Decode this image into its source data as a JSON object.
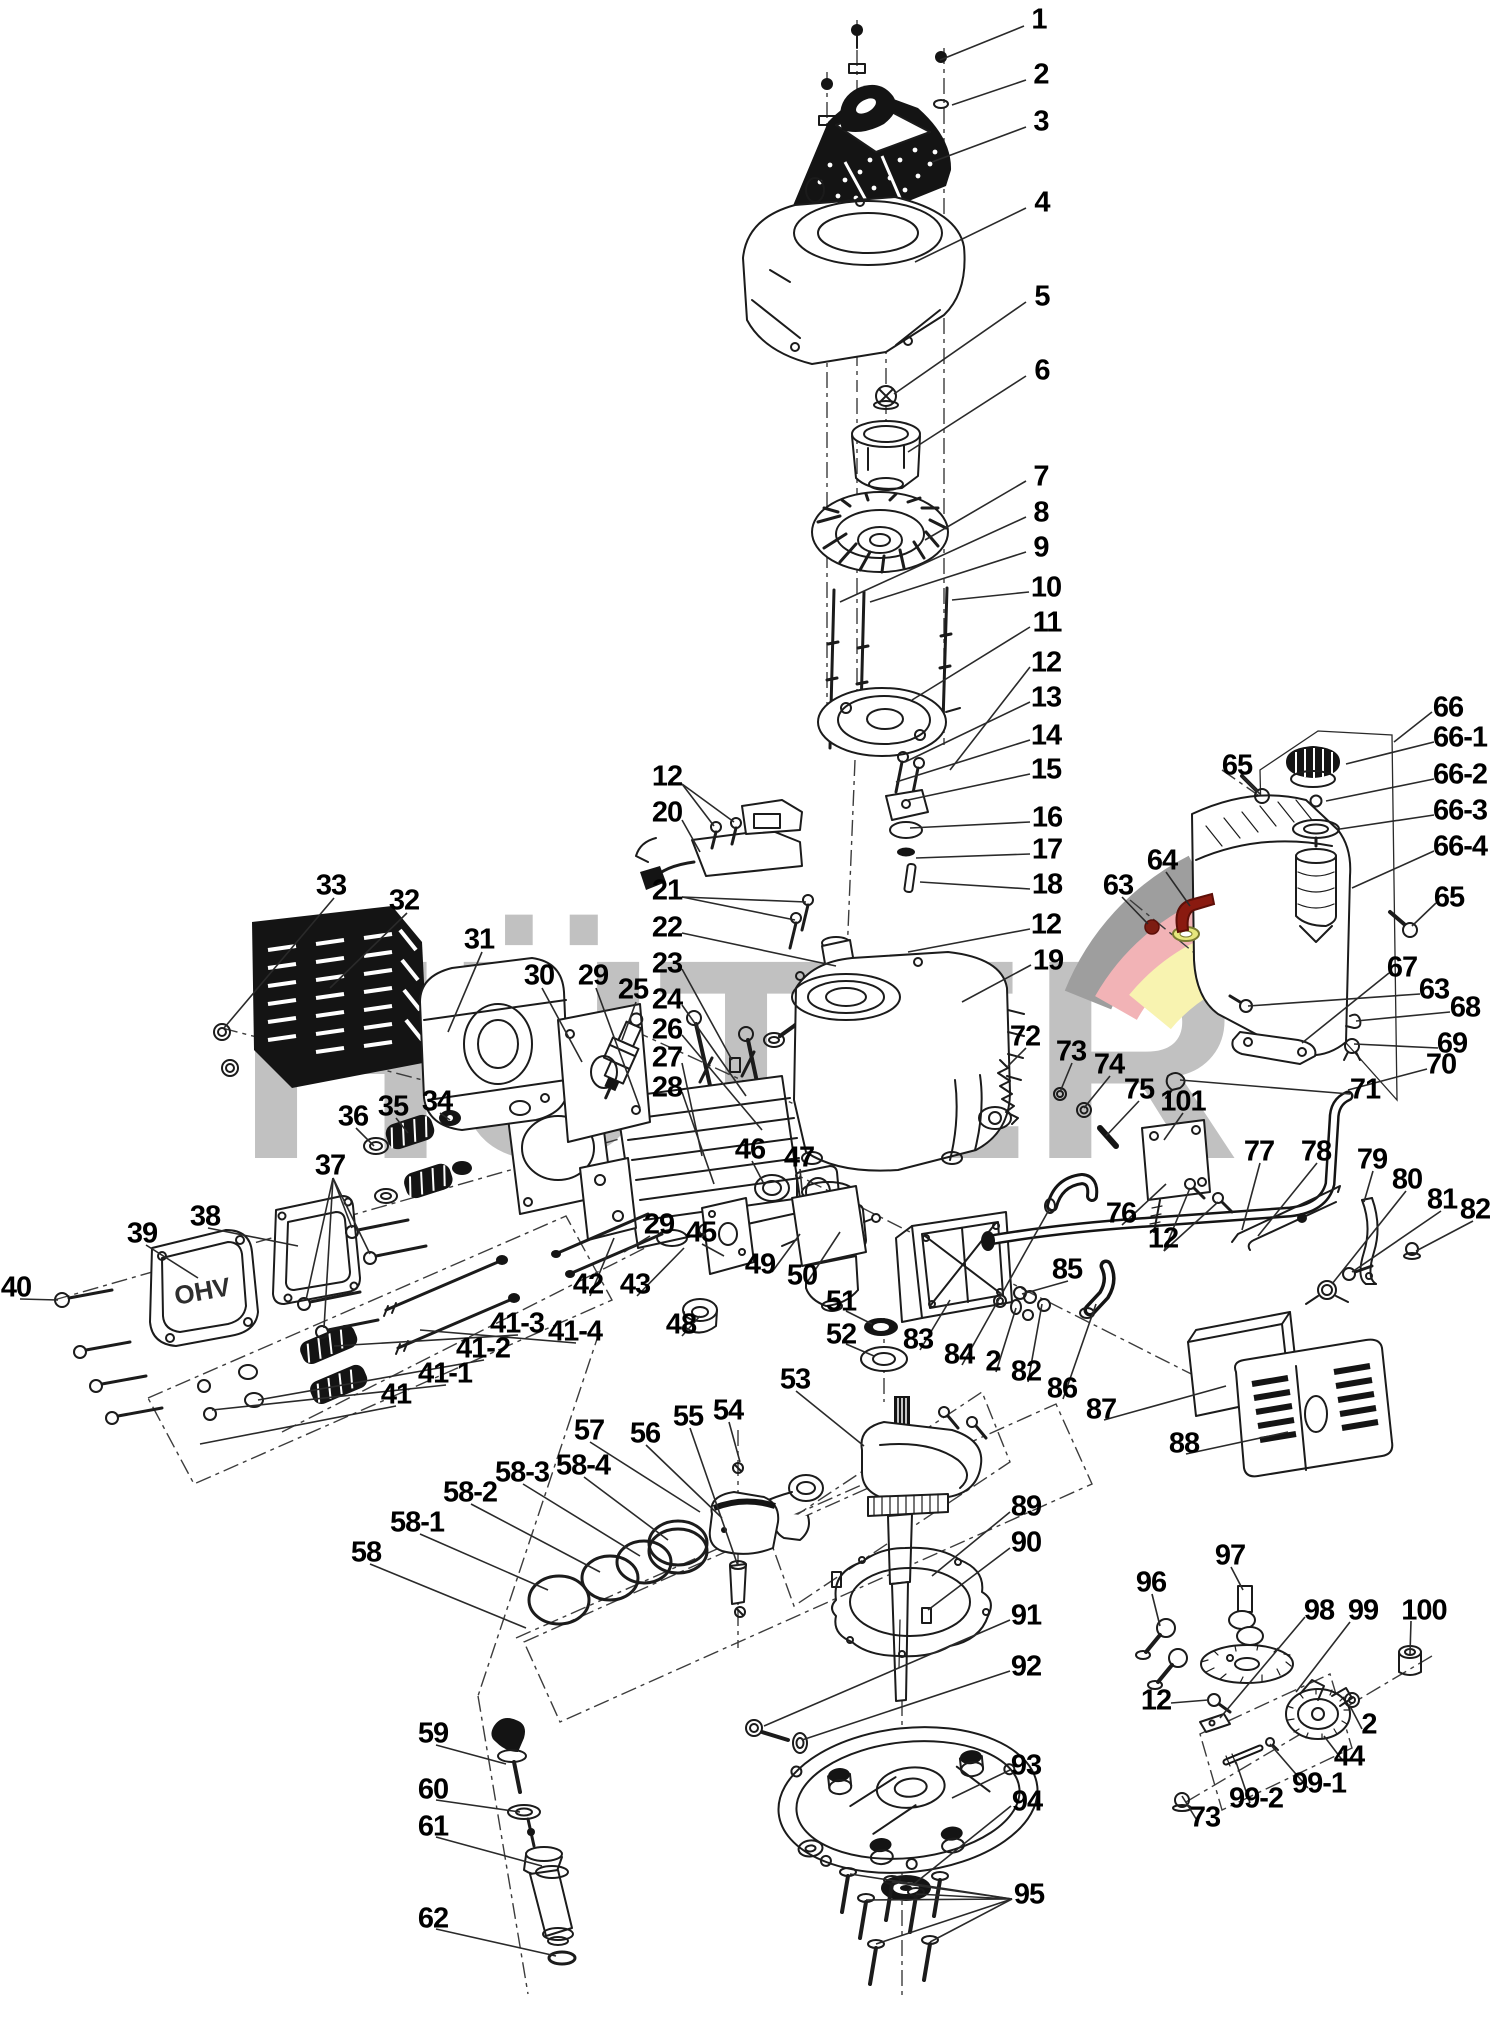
{
  "watermark": {
    "text": "HÜTER",
    "color": "#c1c1c1"
  },
  "logo": {
    "arc_gray": "#9e9e9e",
    "arc_red": "#f2b3b6",
    "arc_yellow": "#f8f3b0"
  },
  "highlighted_parts": {
    "bracket_color": "#8a1a10",
    "nut_color": "#7d1d12",
    "washer_color": "#e7e77d"
  },
  "parts_text": {
    "valve_cover": "OHV"
  },
  "labels": [
    {
      "id": "1",
      "text": "1",
      "x": 1039,
      "y": 20
    },
    {
      "id": "2",
      "text": "2",
      "x": 1041,
      "y": 75
    },
    {
      "id": "3",
      "text": "3",
      "x": 1041,
      "y": 122
    },
    {
      "id": "4",
      "text": "4",
      "x": 1042,
      "y": 203
    },
    {
      "id": "5",
      "text": "5",
      "x": 1042,
      "y": 297
    },
    {
      "id": "6",
      "text": "6",
      "x": 1042,
      "y": 371
    },
    {
      "id": "7",
      "text": "7",
      "x": 1041,
      "y": 477
    },
    {
      "id": "8",
      "text": "8",
      "x": 1041,
      "y": 513
    },
    {
      "id": "9",
      "text": "9",
      "x": 1041,
      "y": 548
    },
    {
      "id": "10",
      "text": "10",
      "x": 1046,
      "y": 588
    },
    {
      "id": "11",
      "text": "11",
      "x": 1047,
      "y": 623
    },
    {
      "id": "12a",
      "text": "12",
      "x": 1046,
      "y": 663
    },
    {
      "id": "13",
      "text": "13",
      "x": 1046,
      "y": 698
    },
    {
      "id": "14",
      "text": "14",
      "x": 1046,
      "y": 736
    },
    {
      "id": "15",
      "text": "15",
      "x": 1046,
      "y": 770
    },
    {
      "id": "16",
      "text": "16",
      "x": 1047,
      "y": 818
    },
    {
      "id": "17",
      "text": "17",
      "x": 1047,
      "y": 850
    },
    {
      "id": "18",
      "text": "18",
      "x": 1047,
      "y": 885
    },
    {
      "id": "12b",
      "text": "12",
      "x": 1046,
      "y": 925
    },
    {
      "id": "19",
      "text": "19",
      "x": 1048,
      "y": 961
    },
    {
      "id": "66",
      "text": "66",
      "x": 1448,
      "y": 708
    },
    {
      "id": "66-1",
      "text": "66-1",
      "x": 1460,
      "y": 738
    },
    {
      "id": "66-2",
      "text": "66-2",
      "x": 1460,
      "y": 775
    },
    {
      "id": "66-3",
      "text": "66-3",
      "x": 1460,
      "y": 811
    },
    {
      "id": "66-4",
      "text": "66-4",
      "x": 1460,
      "y": 847
    },
    {
      "id": "65a",
      "text": "65",
      "x": 1237,
      "y": 766
    },
    {
      "id": "65b",
      "text": "65",
      "x": 1449,
      "y": 898
    },
    {
      "id": "64",
      "text": "64",
      "x": 1162,
      "y": 861
    },
    {
      "id": "63a",
      "text": "63",
      "x": 1118,
      "y": 886
    },
    {
      "id": "67",
      "text": "67",
      "x": 1402,
      "y": 968
    },
    {
      "id": "63b",
      "text": "63",
      "x": 1434,
      "y": 990
    },
    {
      "id": "68",
      "text": "68",
      "x": 1465,
      "y": 1008
    },
    {
      "id": "69",
      "text": "69",
      "x": 1452,
      "y": 1044
    },
    {
      "id": "70",
      "text": "70",
      "x": 1441,
      "y": 1065
    },
    {
      "id": "71",
      "text": "71",
      "x": 1365,
      "y": 1090
    },
    {
      "id": "33",
      "text": "33",
      "x": 331,
      "y": 886
    },
    {
      "id": "32",
      "text": "32",
      "x": 404,
      "y": 901
    },
    {
      "id": "31",
      "text": "31",
      "x": 479,
      "y": 940
    },
    {
      "id": "30",
      "text": "30",
      "x": 539,
      "y": 976
    },
    {
      "id": "29a",
      "text": "29",
      "x": 593,
      "y": 976
    },
    {
      "id": "25",
      "text": "25",
      "x": 633,
      "y": 990
    },
    {
      "id": "12c",
      "text": "12",
      "x": 667,
      "y": 777
    },
    {
      "id": "20",
      "text": "20",
      "x": 667,
      "y": 813
    },
    {
      "id": "21",
      "text": "21",
      "x": 667,
      "y": 891
    },
    {
      "id": "22",
      "text": "22",
      "x": 667,
      "y": 928
    },
    {
      "id": "23",
      "text": "23",
      "x": 667,
      "y": 964
    },
    {
      "id": "24",
      "text": "24",
      "x": 667,
      "y": 1000
    },
    {
      "id": "26",
      "text": "26",
      "x": 667,
      "y": 1030
    },
    {
      "id": "27",
      "text": "27",
      "x": 667,
      "y": 1058
    },
    {
      "id": "28",
      "text": "28",
      "x": 667,
      "y": 1088
    },
    {
      "id": "72",
      "text": "72",
      "x": 1025,
      "y": 1037
    },
    {
      "id": "73a",
      "text": "73",
      "x": 1071,
      "y": 1052
    },
    {
      "id": "74",
      "text": "74",
      "x": 1109,
      "y": 1065
    },
    {
      "id": "75",
      "text": "75",
      "x": 1139,
      "y": 1090
    },
    {
      "id": "101",
      "text": "101",
      "x": 1183,
      "y": 1102
    },
    {
      "id": "36",
      "text": "36",
      "x": 353,
      "y": 1117
    },
    {
      "id": "35",
      "text": "35",
      "x": 393,
      "y": 1107
    },
    {
      "id": "34",
      "text": "34",
      "x": 437,
      "y": 1102
    },
    {
      "id": "37",
      "text": "37",
      "x": 330,
      "y": 1166
    },
    {
      "id": "46",
      "text": "46",
      "x": 750,
      "y": 1150
    },
    {
      "id": "47",
      "text": "47",
      "x": 799,
      "y": 1158
    },
    {
      "id": "77",
      "text": "77",
      "x": 1259,
      "y": 1152
    },
    {
      "id": "78",
      "text": "78",
      "x": 1316,
      "y": 1152
    },
    {
      "id": "79",
      "text": "79",
      "x": 1372,
      "y": 1160
    },
    {
      "id": "80",
      "text": "80",
      "x": 1407,
      "y": 1180
    },
    {
      "id": "81",
      "text": "81",
      "x": 1442,
      "y": 1200
    },
    {
      "id": "82a",
      "text": "82",
      "x": 1475,
      "y": 1210
    },
    {
      "id": "39",
      "text": "39",
      "x": 142,
      "y": 1234
    },
    {
      "id": "38",
      "text": "38",
      "x": 205,
      "y": 1217
    },
    {
      "id": "40",
      "text": "40",
      "x": 16,
      "y": 1288
    },
    {
      "id": "29b",
      "text": "29",
      "x": 659,
      "y": 1225
    },
    {
      "id": "45",
      "text": "45",
      "x": 701,
      "y": 1233
    },
    {
      "id": "42",
      "text": "42",
      "x": 588,
      "y": 1285
    },
    {
      "id": "43",
      "text": "43",
      "x": 635,
      "y": 1285
    },
    {
      "id": "48",
      "text": "48",
      "x": 681,
      "y": 1325
    },
    {
      "id": "49",
      "text": "49",
      "x": 760,
      "y": 1265
    },
    {
      "id": "50",
      "text": "50",
      "x": 802,
      "y": 1276
    },
    {
      "id": "76",
      "text": "76",
      "x": 1121,
      "y": 1214
    },
    {
      "id": "12d",
      "text": "12",
      "x": 1163,
      "y": 1239
    },
    {
      "id": "85",
      "text": "85",
      "x": 1067,
      "y": 1270
    },
    {
      "id": "51",
      "text": "51",
      "x": 841,
      "y": 1302
    },
    {
      "id": "52",
      "text": "52",
      "x": 841,
      "y": 1335
    },
    {
      "id": "83",
      "text": "83",
      "x": 918,
      "y": 1340
    },
    {
      "id": "84",
      "text": "84",
      "x": 959,
      "y": 1355
    },
    {
      "id": "2b",
      "text": "2",
      "x": 993,
      "y": 1362
    },
    {
      "id": "82b",
      "text": "82",
      "x": 1026,
      "y": 1372
    },
    {
      "id": "86",
      "text": "86",
      "x": 1062,
      "y": 1389
    },
    {
      "id": "87",
      "text": "87",
      "x": 1101,
      "y": 1410
    },
    {
      "id": "88",
      "text": "88",
      "x": 1184,
      "y": 1444
    },
    {
      "id": "41",
      "text": "41",
      "x": 396,
      "y": 1395
    },
    {
      "id": "41-1",
      "text": "41-1",
      "x": 445,
      "y": 1374
    },
    {
      "id": "41-2",
      "text": "41-2",
      "x": 483,
      "y": 1349
    },
    {
      "id": "41-3",
      "text": "41-3",
      "x": 517,
      "y": 1324
    },
    {
      "id": "41-4",
      "text": "41-4",
      "x": 575,
      "y": 1332
    },
    {
      "id": "53",
      "text": "53",
      "x": 795,
      "y": 1380
    },
    {
      "id": "54",
      "text": "54",
      "x": 728,
      "y": 1411
    },
    {
      "id": "55",
      "text": "55",
      "x": 688,
      "y": 1417
    },
    {
      "id": "56",
      "text": "56",
      "x": 645,
      "y": 1434
    },
    {
      "id": "57",
      "text": "57",
      "x": 589,
      "y": 1431
    },
    {
      "id": "58-4",
      "text": "58-4",
      "x": 583,
      "y": 1466
    },
    {
      "id": "58-3",
      "text": "58-3",
      "x": 522,
      "y": 1473
    },
    {
      "id": "58-2",
      "text": "58-2",
      "x": 470,
      "y": 1493
    },
    {
      "id": "58-1",
      "text": "58-1",
      "x": 417,
      "y": 1523
    },
    {
      "id": "58",
      "text": "58",
      "x": 366,
      "y": 1553
    },
    {
      "id": "89",
      "text": "89",
      "x": 1026,
      "y": 1507
    },
    {
      "id": "90",
      "text": "90",
      "x": 1026,
      "y": 1543
    },
    {
      "id": "91",
      "text": "91",
      "x": 1026,
      "y": 1616
    },
    {
      "id": "92",
      "text": "92",
      "x": 1026,
      "y": 1667
    },
    {
      "id": "93",
      "text": "93",
      "x": 1026,
      "y": 1766
    },
    {
      "id": "94",
      "text": "94",
      "x": 1027,
      "y": 1802
    },
    {
      "id": "95",
      "text": "95",
      "x": 1029,
      "y": 1895
    },
    {
      "id": "59",
      "text": "59",
      "x": 433,
      "y": 1734
    },
    {
      "id": "60",
      "text": "60",
      "x": 433,
      "y": 1790
    },
    {
      "id": "61",
      "text": "61",
      "x": 433,
      "y": 1827
    },
    {
      "id": "62",
      "text": "62",
      "x": 433,
      "y": 1919
    },
    {
      "id": "96",
      "text": "96",
      "x": 1151,
      "y": 1583
    },
    {
      "id": "97",
      "text": "97",
      "x": 1230,
      "y": 1556
    },
    {
      "id": "98",
      "text": "98",
      "x": 1319,
      "y": 1611
    },
    {
      "id": "99",
      "text": "99",
      "x": 1363,
      "y": 1611
    },
    {
      "id": "100",
      "text": "100",
      "x": 1424,
      "y": 1611
    },
    {
      "id": "12e",
      "text": "12",
      "x": 1156,
      "y": 1701
    },
    {
      "id": "2c",
      "text": "2",
      "x": 1369,
      "y": 1725
    },
    {
      "id": "44",
      "text": "44",
      "x": 1349,
      "y": 1757
    },
    {
      "id": "99-1",
      "text": "99-1",
      "x": 1319,
      "y": 1784
    },
    {
      "id": "99-2",
      "text": "99-2",
      "x": 1256,
      "y": 1799
    },
    {
      "id": "73b",
      "text": "73",
      "x": 1205,
      "y": 1818
    }
  ],
  "leader_lines": [
    [
      1024,
      26,
      940,
      60
    ],
    [
      1026,
      80,
      952,
      105
    ],
    [
      1026,
      127,
      932,
      162
    ],
    [
      1026,
      208,
      915,
      262
    ],
    [
      1026,
      302,
      894,
      394
    ],
    [
      1026,
      376,
      908,
      452
    ],
    [
      1026,
      481,
      925,
      540
    ],
    [
      1026,
      517,
      840,
      602
    ],
    [
      1026,
      552,
      870,
      602
    ],
    [
      1029,
      592,
      952,
      600
    ],
    [
      1030,
      627,
      912,
      700
    ],
    [
      1030,
      667,
      950,
      770
    ],
    [
      1030,
      702,
      905,
      762
    ],
    [
      1030,
      740,
      896,
      782
    ],
    [
      1030,
      774,
      908,
      800
    ],
    [
      1030,
      822,
      910,
      828
    ],
    [
      1030,
      854,
      916,
      858
    ],
    [
      1030,
      889,
      920,
      882
    ],
    [
      1030,
      929,
      908,
      952
    ],
    [
      1031,
      965,
      962,
      1002
    ],
    [
      1432,
      712,
      1394,
      742
    ],
    [
      1434,
      742,
      1346,
      764
    ],
    [
      1434,
      779,
      1326,
      801
    ],
    [
      1434,
      815,
      1340,
      829
    ],
    [
      1434,
      851,
      1352,
      888
    ],
    [
      1243,
      777,
      1260,
      794
    ],
    [
      1436,
      903,
      1412,
      926
    ],
    [
      1166,
      872,
      1190,
      906
    ],
    [
      1122,
      897,
      1148,
      924
    ],
    [
      1389,
      973,
      1302,
      1043
    ],
    [
      1420,
      994,
      1248,
      1006
    ],
    [
      1450,
      1012,
      1356,
      1021
    ],
    [
      1438,
      1048,
      1354,
      1044
    ],
    [
      1427,
      1069,
      1348,
      1090
    ],
    [
      1350,
      1094,
      1180,
      1080
    ],
    [
      334,
      898,
      224,
      1028
    ],
    [
      407,
      913,
      330,
      988
    ],
    [
      482,
      952,
      448,
      1032
    ],
    [
      542,
      988,
      582,
      1062
    ],
    [
      596,
      988,
      640,
      1108
    ],
    [
      636,
      1002,
      622,
      1040
    ],
    [
      682,
      784,
      714,
      826
    ],
    [
      682,
      784,
      734,
      822
    ],
    [
      682,
      820,
      700,
      852
    ],
    [
      682,
      897,
      806,
      902
    ],
    [
      682,
      897,
      795,
      920
    ],
    [
      682,
      933,
      836,
      966
    ],
    [
      682,
      969,
      732,
      1060
    ],
    [
      682,
      1005,
      746,
      1096
    ],
    [
      682,
      1035,
      762,
      1130
    ],
    [
      682,
      1063,
      702,
      1156
    ],
    [
      682,
      1092,
      714,
      1184
    ],
    [
      1026,
      1048,
      1008,
      1066
    ],
    [
      1072,
      1063,
      1060,
      1092
    ],
    [
      1110,
      1076,
      1084,
      1108
    ],
    [
      1139,
      1101,
      1106,
      1136
    ],
    [
      1183,
      1113,
      1164,
      1140
    ],
    [
      356,
      1128,
      374,
      1146
    ],
    [
      396,
      1118,
      408,
      1133
    ],
    [
      440,
      1113,
      450,
      1120
    ],
    [
      333,
      1178,
      352,
      1228
    ],
    [
      333,
      1178,
      370,
      1254
    ],
    [
      333,
      1178,
      306,
      1300
    ],
    [
      333,
      1178,
      324,
      1328
    ],
    [
      752,
      1161,
      764,
      1184
    ],
    [
      800,
      1169,
      802,
      1190
    ],
    [
      1260,
      1163,
      1242,
      1230
    ],
    [
      1317,
      1163,
      1258,
      1236
    ],
    [
      1373,
      1171,
      1364,
      1202
    ],
    [
      1406,
      1191,
      1332,
      1284
    ],
    [
      1441,
      1211,
      1352,
      1272
    ],
    [
      1473,
      1221,
      1416,
      1251
    ],
    [
      146,
      1245,
      198,
      1278
    ],
    [
      208,
      1228,
      298,
      1246
    ],
    [
      20,
      1299,
      58,
      1300
    ],
    [
      650,
      1236,
      624,
      1252
    ],
    [
      702,
      1244,
      724,
      1256
    ],
    [
      590,
      1296,
      614,
      1238
    ],
    [
      637,
      1296,
      684,
      1248
    ],
    [
      682,
      1336,
      700,
      1316
    ],
    [
      772,
      1272,
      800,
      1234
    ],
    [
      806,
      1284,
      840,
      1232
    ],
    [
      1122,
      1225,
      1166,
      1184
    ],
    [
      1164,
      1251,
      1190,
      1188
    ],
    [
      1164,
      1251,
      1218,
      1202
    ],
    [
      1068,
      1281,
      1022,
      1294
    ],
    [
      846,
      1311,
      872,
      1324
    ],
    [
      846,
      1344,
      874,
      1356
    ],
    [
      920,
      1350,
      950,
      1300
    ],
    [
      962,
      1365,
      1050,
      1208
    ],
    [
      996,
      1372,
      1016,
      1308
    ],
    [
      1028,
      1382,
      1042,
      1304
    ],
    [
      1063,
      1399,
      1096,
      1304
    ],
    [
      1104,
      1420,
      1226,
      1386
    ],
    [
      1186,
      1454,
      1288,
      1432
    ],
    [
      396,
      1406,
      200,
      1444
    ],
    [
      446,
      1385,
      212,
      1410
    ],
    [
      484,
      1360,
      258,
      1400
    ],
    [
      518,
      1335,
      334,
      1346
    ],
    [
      576,
      1343,
      420,
      1330
    ],
    [
      796,
      1391,
      864,
      1446
    ],
    [
      729,
      1422,
      740,
      1462
    ],
    [
      690,
      1428,
      738,
      1566
    ],
    [
      646,
      1445,
      722,
      1518
    ],
    [
      590,
      1442,
      700,
      1512
    ],
    [
      584,
      1477,
      668,
      1540
    ],
    [
      523,
      1484,
      640,
      1556
    ],
    [
      471,
      1504,
      600,
      1572
    ],
    [
      420,
      1534,
      548,
      1590
    ],
    [
      370,
      1564,
      526,
      1628
    ],
    [
      1010,
      1512,
      932,
      1576
    ],
    [
      1010,
      1548,
      928,
      1610
    ],
    [
      1010,
      1620,
      764,
      1726
    ],
    [
      1010,
      1671,
      802,
      1740
    ],
    [
      1010,
      1770,
      952,
      1798
    ],
    [
      1011,
      1806,
      914,
      1884
    ],
    [
      1012,
      1899,
      850,
      1874
    ],
    [
      1012,
      1899,
      866,
      1900
    ],
    [
      1012,
      1899,
      892,
      1882
    ],
    [
      1012,
      1899,
      916,
      1894
    ],
    [
      1012,
      1899,
      876,
      1944
    ],
    [
      1012,
      1899,
      930,
      1942
    ],
    [
      436,
      1745,
      506,
      1764
    ],
    [
      436,
      1800,
      520,
      1812
    ],
    [
      436,
      1837,
      542,
      1866
    ],
    [
      436,
      1929,
      556,
      1956
    ],
    [
      1152,
      1594,
      1160,
      1626
    ],
    [
      1231,
      1567,
      1243,
      1590
    ],
    [
      1305,
      1617,
      1220,
      1718
    ],
    [
      1350,
      1622,
      1296,
      1692
    ],
    [
      1411,
      1621,
      1410,
      1654
    ],
    [
      1171,
      1703,
      1208,
      1700
    ],
    [
      1362,
      1729,
      1350,
      1706
    ],
    [
      1343,
      1761,
      1324,
      1736
    ],
    [
      1308,
      1788,
      1270,
      1744
    ],
    [
      1250,
      1803,
      1236,
      1762
    ],
    [
      1198,
      1822,
      1182,
      1796
    ]
  ]
}
